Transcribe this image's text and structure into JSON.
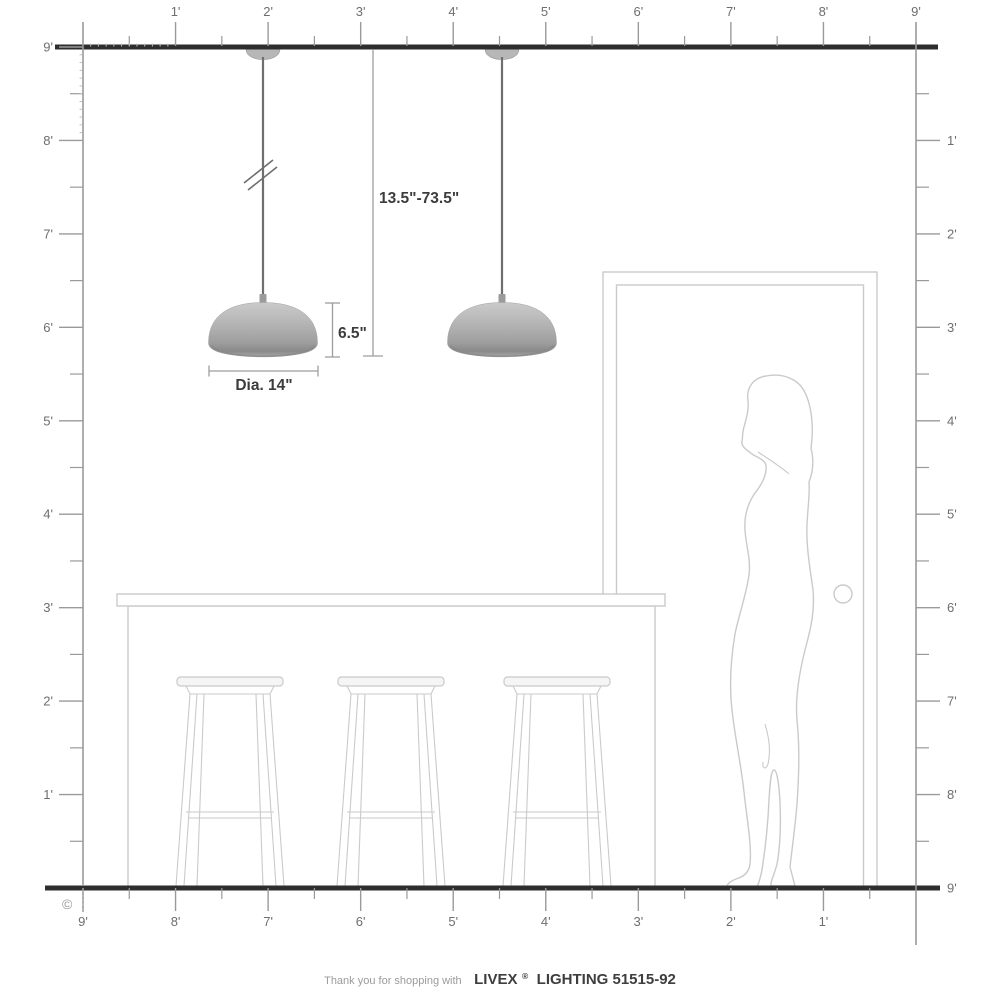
{
  "rulers": {
    "unit": "feet",
    "top": {
      "labels": [
        "1'",
        "2'",
        "3'",
        "4'",
        "5'",
        "6'",
        "7'",
        "8'",
        "9'"
      ]
    },
    "left": {
      "labels": [
        "9'",
        "8'",
        "7'",
        "6'",
        "5'",
        "4'",
        "3'",
        "2'",
        "1'"
      ]
    },
    "right": {
      "labels": [
        "1'",
        "2'",
        "3'",
        "4'",
        "5'",
        "6'",
        "7'",
        "8'"
      ],
      "floor_label": "9'"
    },
    "bottom": {
      "labels": [
        "9'",
        "8'",
        "7'",
        "6'",
        "5'",
        "4'",
        "3'",
        "2'",
        "1'"
      ]
    }
  },
  "dimensions": {
    "hang_range": "13.5\"-73.5\"",
    "shade_height": "6.5\"",
    "shade_diameter": "Dia. 14\""
  },
  "caption": {
    "prefix": "Thank you for shopping with",
    "brand": "LIVEX",
    "registered_mark": "®",
    "product": "LIGHTING 51515-92"
  },
  "copyright_symbol": "©",
  "colors": {
    "structure": "#2e2e2e",
    "ruler": "#9a9a9a",
    "ruler_label": "#6e6e6e",
    "inch_tick": "#c0c0c0",
    "outline": "#cacaca",
    "dimension": "#9d9d9d",
    "dimension_text": "#3c3c3c",
    "cord": "#6f6f6f",
    "shade_top": "#cacaca",
    "shade_mid": "#b3b3b3",
    "shade_low": "#9e9e9e",
    "shade_rim": "#898989",
    "shade_bottom": "#a7a7a7",
    "caption_light": "#9b9b9b",
    "caption_dark": "#3e3e3e"
  }
}
